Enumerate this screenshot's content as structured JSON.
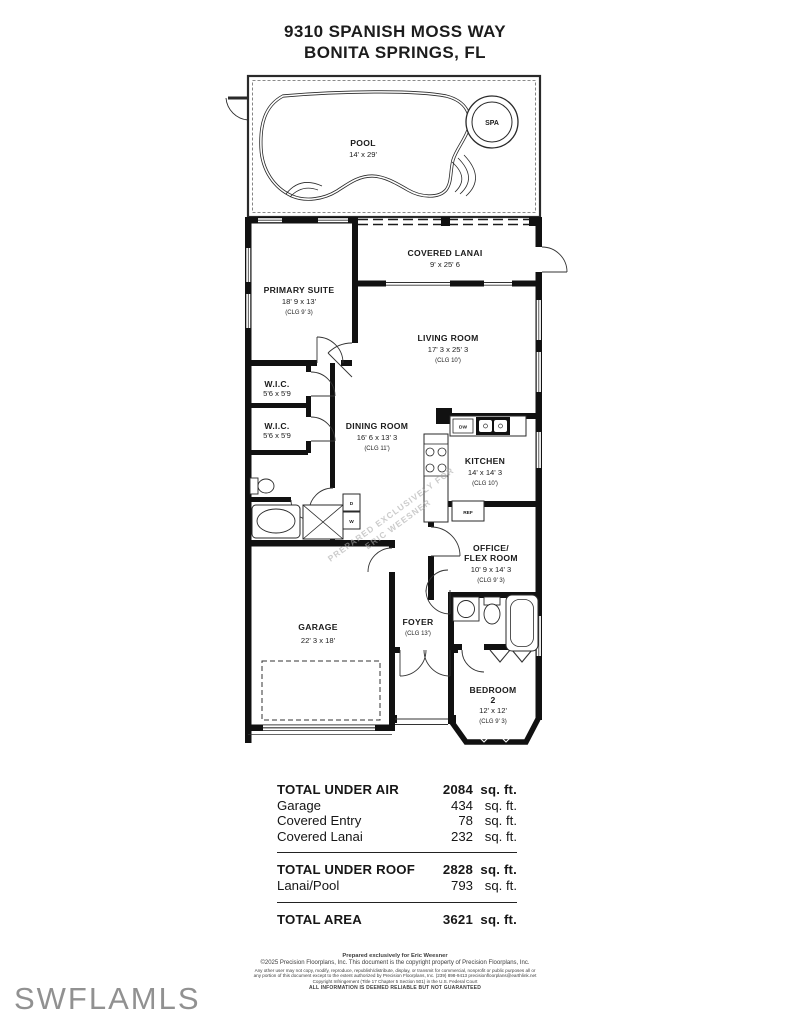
{
  "title": {
    "line1": "9310 SPANISH MOSS WAY",
    "line2": "BONITA SPRINGS, FL"
  },
  "plan": {
    "watermark": {
      "line1": "PREPARED EXCLUSIVELY FOR",
      "line2": "ERIC WEESNER"
    },
    "rooms": {
      "pool": {
        "name": "POOL",
        "dims": "14' x 29'"
      },
      "spa": {
        "name": "SPA"
      },
      "covered_lanai": {
        "name": "COVERED LANAI",
        "dims": "9' x 25' 6"
      },
      "primary_suite": {
        "name": "PRIMARY SUITE",
        "dims": "18' 9 x 13'",
        "clg": "(CLG 9' 3)"
      },
      "living_room": {
        "name": "LIVING ROOM",
        "dims": "17' 3 x 25' 3",
        "clg": "(CLG 10')"
      },
      "wic_1": {
        "name": "W.I.C.",
        "dims": "5'6 x 5'9"
      },
      "wic_2": {
        "name": "W.I.C.",
        "dims": "5'6 x 5'9"
      },
      "dining_room": {
        "name": "DINING ROOM",
        "dims": "16' 6 x 13' 3",
        "clg": "(CLG 11')"
      },
      "kitchen": {
        "name": "KITCHEN",
        "dims": "14' x 14' 3",
        "clg": "(CLG 10')"
      },
      "office_flex": {
        "name_line1": "OFFICE/",
        "name_line2": "FLEX ROOM",
        "dims": "10' 9 x 14' 3",
        "clg": "(CLG 9' 3)"
      },
      "garage": {
        "name": "GARAGE",
        "dims": "22' 3 x 18'"
      },
      "foyer": {
        "name": "FOYER",
        "clg": "(CLG 13')"
      },
      "bedroom_2": {
        "name_line1": "BEDROOM",
        "name_line2": "2",
        "dims": "12' x 12'",
        "clg": "(CLG 9' 3)"
      }
    },
    "fixtures": {
      "dw": "DW",
      "ref": "REF",
      "washer": "W",
      "dryer": "D"
    }
  },
  "area_table": {
    "total_under_air": {
      "label": "TOTAL UNDER AIR",
      "value": "2084",
      "unit": "sq. ft."
    },
    "garage": {
      "label": "Garage",
      "value": "434",
      "unit": "sq. ft."
    },
    "covered_entry": {
      "label": "Covered Entry",
      "value": "78",
      "unit": "sq. ft."
    },
    "covered_lanai": {
      "label": "Covered Lanai",
      "value": "232",
      "unit": "sq. ft."
    },
    "total_under_roof": {
      "label": "TOTAL UNDER ROOF",
      "value": "2828",
      "unit": "sq. ft."
    },
    "lanai_pool": {
      "label": "Lanai/Pool",
      "value": "793",
      "unit": "sq. ft."
    },
    "total_area": {
      "label": "TOTAL AREA",
      "value": "3621",
      "unit": "sq. ft."
    }
  },
  "footer": {
    "line1": "Prepared exclusively for Eric Weesner",
    "line2": "©2025 Precision Floorplans, Inc.  This document is the copyright property of Precision Floorplans, Inc.",
    "line3": "Any other user may not copy, modify, reproduce, republish/distribute, display, or transmit for commercial, nonprofit or public purposes all or",
    "line4": "any portion of this document except to the extent authorized by Precision Floorplans, Inc. (239) 898-9413 precisionfloorplans@earthlink.net",
    "line5": "Copyright Infringement (Title 17 Chapter 5 Section 501) in the U.S. Federal Court",
    "line6": "ALL INFORMATION IS DEEMED RELIABLE BUT NOT GUARANTEED"
  },
  "branding": {
    "watermark": "SWFLAMLS"
  },
  "colors": {
    "wall": "#111111",
    "line": "#2a2a2a",
    "watermark_gray": "#919191"
  }
}
